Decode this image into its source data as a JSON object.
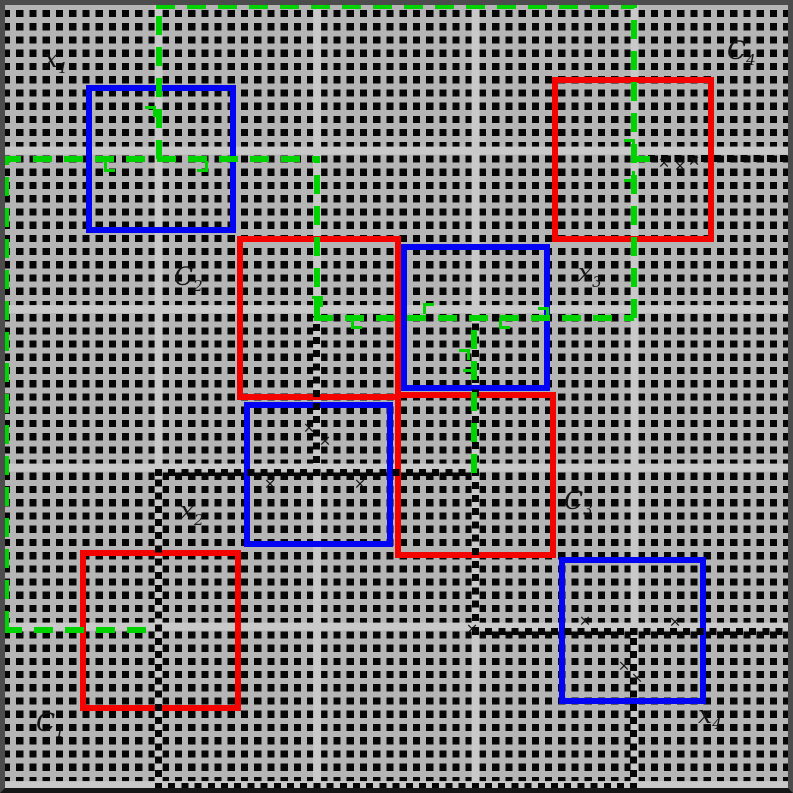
{
  "colors": {
    "red": "#f40400",
    "blue": "#0404f4",
    "green": "#00d400",
    "grid_bg": "#b5b5b5",
    "grid_dot": "#060606",
    "grid_major": "#c9c9c9",
    "chain_dot": "#060606",
    "frame": "#4c4c4c",
    "frame_bottom": "#161616",
    "label": "#141414"
  },
  "grid": {
    "minor_pitch": 13.22,
    "gutter": 6,
    "dot_size": 7.2,
    "major_pitch": 158.6,
    "major_width": 8,
    "major_offset": 154.6,
    "minor_offset": -3
  },
  "squares": [
    {
      "name": "blue-square-top-left",
      "color": "blue",
      "x": 86,
      "y": 85,
      "w": 150,
      "h": 148
    },
    {
      "name": "blue-square-mid-right",
      "color": "blue",
      "x": 401,
      "y": 244,
      "w": 149,
      "h": 147
    },
    {
      "name": "blue-square-center",
      "color": "blue",
      "x": 244,
      "y": 402,
      "w": 149,
      "h": 145
    },
    {
      "name": "blue-square-bottom-right",
      "color": "blue",
      "x": 559,
      "y": 557,
      "w": 147,
      "h": 147
    },
    {
      "name": "red-square-top-right",
      "color": "red",
      "x": 552,
      "y": 77,
      "w": 162,
      "h": 165
    },
    {
      "name": "red-square-mid-left",
      "color": "red",
      "x": 237,
      "y": 236,
      "w": 164,
      "h": 164
    },
    {
      "name": "red-square-center-right",
      "color": "red",
      "x": 395,
      "y": 392,
      "w": 161,
      "h": 166
    },
    {
      "name": "red-square-bottom-left",
      "color": "red",
      "x": 80,
      "y": 550,
      "w": 161,
      "h": 161
    }
  ],
  "dotted_chains": [
    {
      "name": "chain-top-right",
      "dir": "h",
      "x": 648,
      "y": 155,
      "len": 145
    },
    {
      "name": "chain-center-vert",
      "dir": "v",
      "x": 313,
      "y": 316,
      "len": 160
    },
    {
      "name": "chain-mid-horiz",
      "dir": "h",
      "x": 155,
      "y": 469,
      "len": 325
    },
    {
      "name": "chain-right-center-vert",
      "dir": "v",
      "x": 472,
      "y": 316,
      "len": 318
    },
    {
      "name": "chain-lower-horiz",
      "dir": "h",
      "x": 472,
      "y": 628,
      "len": 321
    },
    {
      "name": "chain-lower-right-vert",
      "dir": "v",
      "x": 630,
      "y": 628,
      "len": 162
    },
    {
      "name": "chain-bottom-edge",
      "dir": "h",
      "x": 155,
      "y": 783,
      "len": 478
    },
    {
      "name": "chain-left-lower-vert",
      "dir": "v",
      "x": 155,
      "y": 469,
      "len": 321
    }
  ],
  "green_dashed": [
    {
      "name": "green-top-left-vert",
      "dir": "v",
      "x": 156,
      "y": 3,
      "len": 156
    },
    {
      "name": "green-upper-horiz",
      "dir": "h",
      "x": 2,
      "y": 156,
      "len": 315
    },
    {
      "name": "green-upper-mid-vert",
      "dir": "v",
      "x": 314,
      "y": 156,
      "len": 162
    },
    {
      "name": "green-top-edge",
      "dir": "h",
      "x": 156,
      "y": 3,
      "len": 478
    },
    {
      "name": "green-right-vert",
      "dir": "v",
      "x": 631,
      "y": 3,
      "len": 315
    },
    {
      "name": "green-center-horiz",
      "dir": "h",
      "x": 314,
      "y": 315,
      "len": 320
    },
    {
      "name": "green-left-edge-vert",
      "dir": "v",
      "x": 3,
      "y": 156,
      "len": 474
    },
    {
      "name": "green-lower-left-horiz",
      "dir": "h",
      "x": 3,
      "y": 627,
      "len": 155
    },
    {
      "name": "green-center-vert",
      "dir": "v",
      "x": 471,
      "y": 318,
      "len": 155
    },
    {
      "name": "green-right-stub",
      "dir": "h",
      "x": 631,
      "y": 156,
      "len": 26
    }
  ],
  "arrow_hooks": [
    {
      "x": 145,
      "y": 106,
      "t": "tr"
    },
    {
      "x": 104,
      "y": 161,
      "t": "bl"
    },
    {
      "x": 197,
      "y": 161,
      "t": "br"
    },
    {
      "x": 312,
      "y": 296,
      "t": "tr"
    },
    {
      "x": 351,
      "y": 318,
      "t": "bl"
    },
    {
      "x": 423,
      "y": 303,
      "t": "tl"
    },
    {
      "x": 499,
      "y": 318,
      "t": "bl"
    },
    {
      "x": 538,
      "y": 307,
      "t": "tr"
    },
    {
      "x": 624,
      "y": 139,
      "t": "tr"
    },
    {
      "x": 624,
      "y": 171,
      "t": "br"
    },
    {
      "x": 459,
      "y": 349,
      "t": "tr"
    },
    {
      "x": 463,
      "y": 361,
      "t": "br"
    }
  ],
  "cross_glyph": "×",
  "cross_marks": [
    {
      "x": 664,
      "y": 163
    },
    {
      "x": 680,
      "y": 166
    },
    {
      "x": 694,
      "y": 161
    },
    {
      "x": 309,
      "y": 428
    },
    {
      "x": 325,
      "y": 441
    },
    {
      "x": 270,
      "y": 484
    },
    {
      "x": 360,
      "y": 484
    },
    {
      "x": 585,
      "y": 621
    },
    {
      "x": 675,
      "y": 622
    },
    {
      "x": 624,
      "y": 666
    },
    {
      "x": 637,
      "y": 678
    },
    {
      "x": 472,
      "y": 629
    }
  ],
  "labels": [
    {
      "id": "x1",
      "base": "x",
      "sub": "1",
      "x": 44,
      "y": 46
    },
    {
      "id": "C4",
      "base": "C",
      "sub": "4",
      "x": 727,
      "y": 38
    },
    {
      "id": "C2",
      "base": "C",
      "sub": "2",
      "x": 174,
      "y": 264
    },
    {
      "id": "x3",
      "base": "x",
      "sub": "3",
      "x": 578,
      "y": 260
    },
    {
      "id": "x2",
      "base": "x",
      "sub": "2",
      "x": 180,
      "y": 498
    },
    {
      "id": "C3",
      "base": "C",
      "sub": "3",
      "x": 564,
      "y": 488
    },
    {
      "id": "C1",
      "base": "C",
      "sub": "1",
      "x": 36,
      "y": 710
    },
    {
      "id": "x4",
      "base": "x",
      "sub": "4",
      "x": 698,
      "y": 702
    }
  ]
}
